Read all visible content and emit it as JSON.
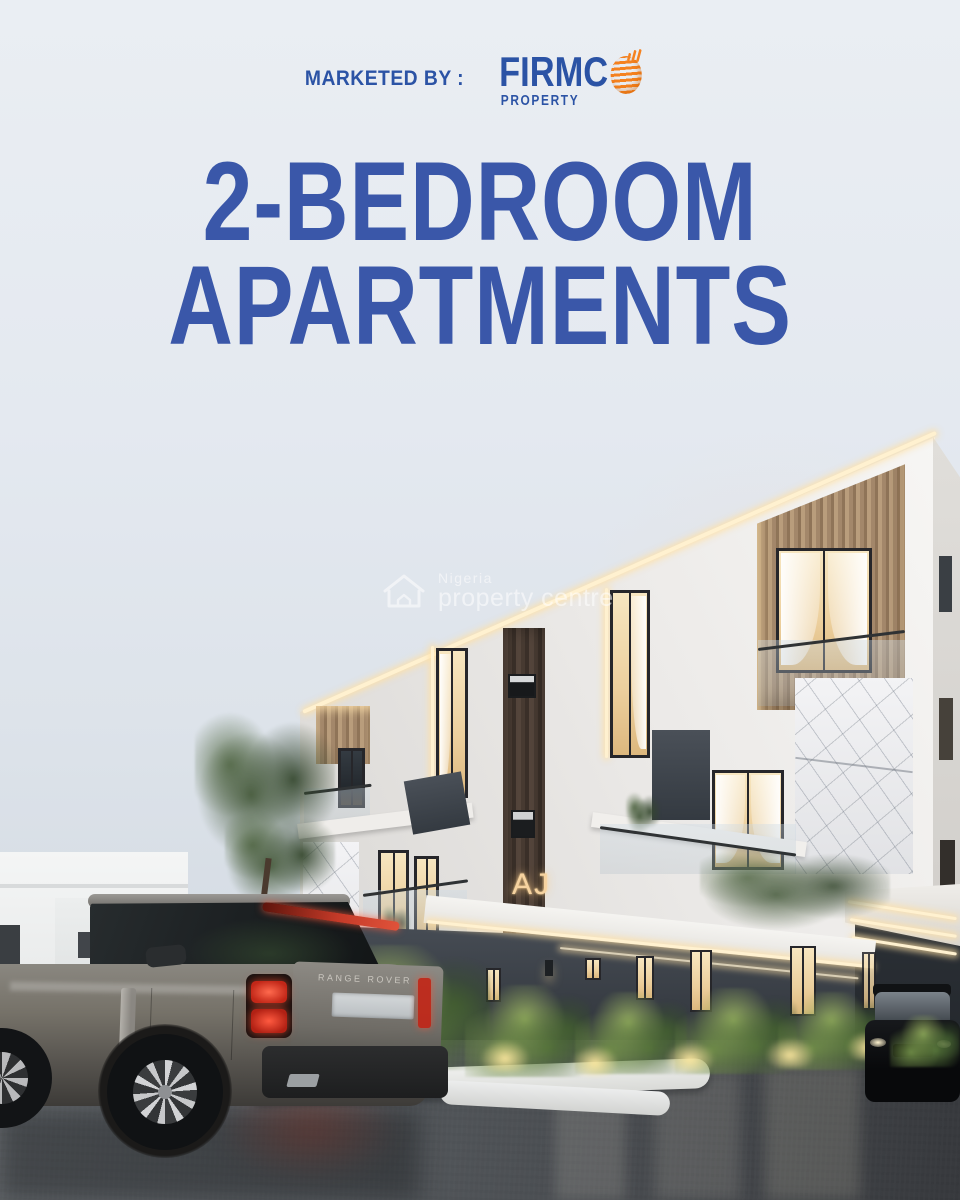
{
  "header": {
    "marketed_by_label": "MARKETED BY :",
    "brand_name": "FIRMC",
    "brand_suffix": "PROPERTY",
    "brand_icon": "orange-striped-globe-with-chart-bars"
  },
  "headline": {
    "line1": "2-BEDROOM",
    "line2": "APARTMENTS"
  },
  "watermark": {
    "icon": "house-outline-icon",
    "line1": "Nigeria",
    "line2": "property centre"
  },
  "scene": {
    "building_sign_text": "AJ",
    "car_badge_text": "RANGE ROVER",
    "description": "Dusk 3D render of a modern white 3-storey apartment building with wood and marble accents, lit windows, ferns with uplights, a grey Range Rover SUV in the wet foreground and a black SUV at right"
  },
  "colors": {
    "headline_blue": "#3a57a9",
    "brand_blue": "#2b53a5",
    "brand_orange": "#f58220",
    "sky_top": "#eaeef3",
    "led_warm": "#fff1d0",
    "window_glow": "#f0d6a4",
    "taillight_red": "#d23a28",
    "building_white": "#f4f3f1",
    "ground_charcoal": "#3a4046",
    "pavement": "#4a4e52"
  }
}
